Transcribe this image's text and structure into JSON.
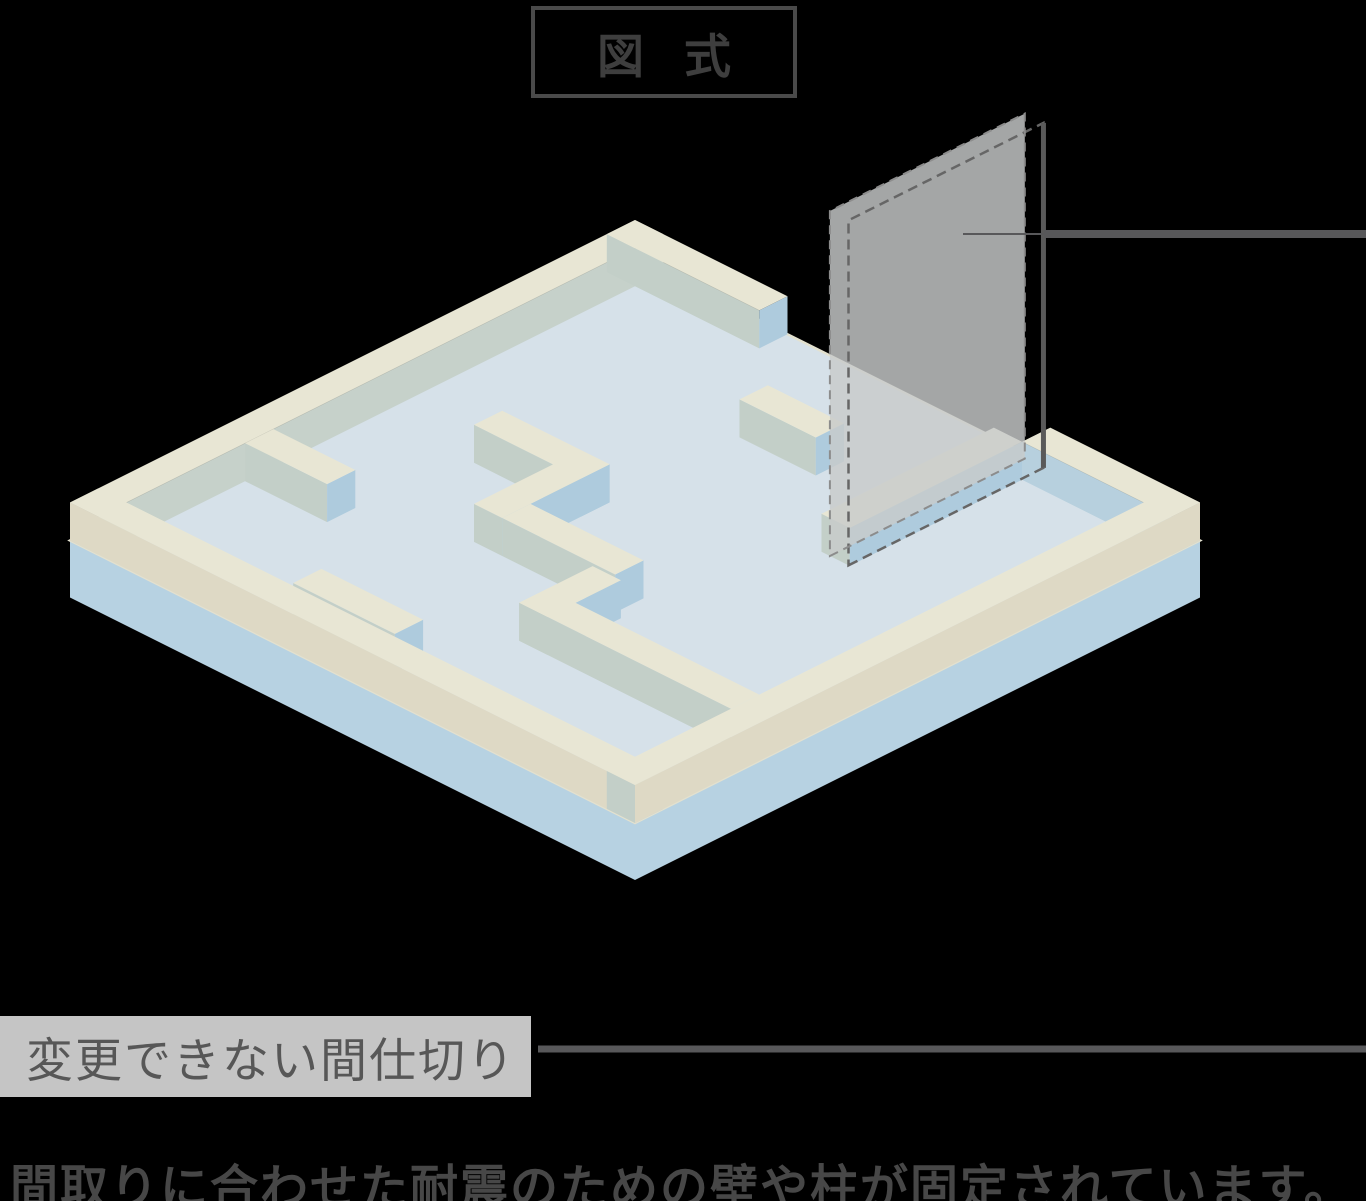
{
  "page": {
    "bg": "#000000"
  },
  "title_box": {
    "text": "図式",
    "border_color": "#4a4a4a",
    "text_color": "#3e3e3e"
  },
  "partition_label": {
    "text": "変更できない間仕切り",
    "bg": "#c5c5c5",
    "text_color": "#575757"
  },
  "caption": {
    "text": "間取りに合わせた耐震のための壁や柱が固定されています。",
    "color": "#474747"
  },
  "diagram": {
    "iso": {
      "ox": 635,
      "oy": 258,
      "k": 56.5,
      "wall_height": 38,
      "slab_thickness": 57,
      "floor_color": "#d6e1e9",
      "floor_edge_color": "#e3e1cf",
      "top_color": "#e8e6d4",
      "face_a_color": "#c3cfc8",
      "face_b_color": "#aecbdd",
      "slab_side_color": "#b7d2e2"
    },
    "walls": [
      {
        "id": "rim-top-left",
        "a1": 0,
        "b1": 0,
        "a2": 10,
        "b2": 0.5,
        "fa": "#c6d1ca",
        "fb": "#c6d1ca"
      },
      {
        "id": "rim-top-right-a",
        "a1": 0,
        "b1": 0,
        "a2": 0.5,
        "b2": 2.7
      },
      {
        "id": "rim-top-right-b",
        "a1": 0,
        "b1": 7.35,
        "a2": 0.5,
        "b2": 10,
        "fa": "#b7d0de"
      },
      {
        "id": "stub-wall",
        "a1": 1.75,
        "b1": 4.1,
        "a2": 2.25,
        "b2": 5.45
      },
      {
        "id": "socket-wall",
        "a1": 0.5,
        "b1": 6.85,
        "a2": 3.55,
        "b2": 7.35,
        "fb": "#aecbdd"
      },
      {
        "id": "wall-upper-left",
        "a1": 6.9,
        "b1": 0.5,
        "a2": 7.4,
        "b2": 1.95
      },
      {
        "id": "wall-center-1",
        "a1": 4.55,
        "b1": 2.2,
        "a2": 5.05,
        "b2": 4.1
      },
      {
        "id": "wall-center-2",
        "a1": 4.55,
        "b1": 3.6,
        "a2": 6.45,
        "b2": 4.1
      },
      {
        "id": "wall-center-3",
        "a1": 5.95,
        "b1": 4.1,
        "a2": 6.45,
        "b2": 6.1
      },
      {
        "id": "wall-lower-arm",
        "a1": 6.5,
        "b1": 5.75,
        "a2": 7.8,
        "b2": 6.25
      },
      {
        "id": "wall-lower-long",
        "a1": 7.3,
        "b1": 5.75,
        "a2": 7.8,
        "b2": 9.5,
        "fb": "none"
      },
      {
        "id": "wall-lower-left",
        "a1": 8.95,
        "b1": 3.4,
        "a2": 9.45,
        "b2": 5.2
      },
      {
        "id": "rim-bottom-left",
        "a1": 9.5,
        "b1": 0,
        "a2": 10,
        "b2": 10,
        "fa": "#ded9c5"
      },
      {
        "id": "rim-bottom-right",
        "a1": 0,
        "b1": 9.5,
        "a2": 10,
        "b2": 10,
        "fb": "#ded9c5"
      }
    ],
    "partition": {
      "b": 7.0,
      "a1": 0.1,
      "a2": 3.55,
      "height": 345,
      "thickness_dx": 18.6,
      "thickness_dy": 9.3,
      "fill": "#c8cacb",
      "fill_opacity": 0.82,
      "dash_front_color": "#8c8c8c",
      "dash_back_color": "#666666",
      "edge_color": "#5a5a5a"
    },
    "leader_partition": {
      "x_tip": 963,
      "y": 234,
      "x_bar": 1044,
      "x_end": 1366,
      "thin_width": 2,
      "thick_width": 8,
      "color": "#58585a"
    },
    "leader_label": {
      "x1": 538,
      "x2": 1366,
      "y": 1049,
      "width": 7,
      "color": "#58585a"
    }
  }
}
